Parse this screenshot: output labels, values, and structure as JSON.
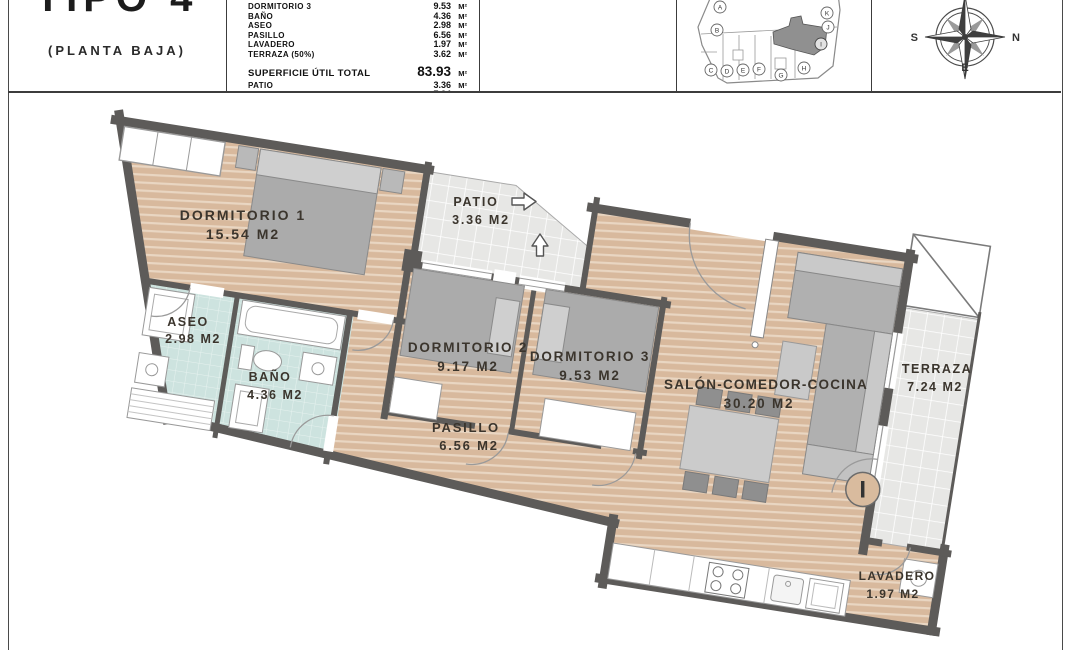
{
  "header": {
    "title": "TIPO 4",
    "subtitle": "(PLANTA BAJA)",
    "table": {
      "unit": "M²",
      "rows": [
        {
          "label": "DORMITORIO 3",
          "value": "9.53"
        },
        {
          "label": "BAÑO",
          "value": "4.36"
        },
        {
          "label": "ASEO",
          "value": "2.98"
        },
        {
          "label": "PASILLO",
          "value": "6.56"
        },
        {
          "label": "LAVADERO",
          "value": "1.97"
        },
        {
          "label": "TERRAZA (50%)",
          "value": "3.62"
        }
      ],
      "total": {
        "label": "SUPERFICIE ÚTIL TOTAL",
        "value": "83.93"
      },
      "extra_rows": [
        {
          "label": "PATIO",
          "value": "3.36"
        },
        {
          "label": "TERRAZA (100%)",
          "value": "7.24"
        }
      ]
    },
    "keyplan": {
      "units": [
        "A",
        "B",
        "C",
        "D",
        "E",
        "F",
        "G",
        "H",
        "I",
        "J",
        "K"
      ],
      "highlighted": "I"
    },
    "compass": {
      "left": "S",
      "right": "N",
      "bottom": "E"
    }
  },
  "plan": {
    "unit_marker": "I",
    "rooms": {
      "dormitorio1": {
        "name": "DORMITORIO 1",
        "area": "15.54 M2"
      },
      "patio": {
        "name": "PATIO",
        "area": "3.36 M2"
      },
      "aseo": {
        "name": "ASEO",
        "area": "2.98 M2"
      },
      "bano": {
        "name": "BAÑO",
        "area": "4.36 M2"
      },
      "dormitorio2": {
        "name": "DORMITORIO 2",
        "area": "9.17 M2"
      },
      "dormitorio3": {
        "name": "DORMITORIO 3",
        "area": "9.53 M2"
      },
      "pasillo": {
        "name": "PASILLO",
        "area": "6.56 M2"
      },
      "salon": {
        "name": "SALÓN-COMEDOR-COCINA",
        "area": "30.20 M2"
      },
      "terraza": {
        "name": "TERRAZA",
        "area": "7.24 M2"
      },
      "lavadero": {
        "name": "LAVADERO",
        "area": "1.97 M2"
      }
    },
    "colors": {
      "wall": "#5d5b59",
      "wood_floor": "#d8b99d",
      "bath_floor": "#cde3df",
      "tile_floor": "#e7e7e5",
      "highlight_unit": "#909090"
    }
  }
}
